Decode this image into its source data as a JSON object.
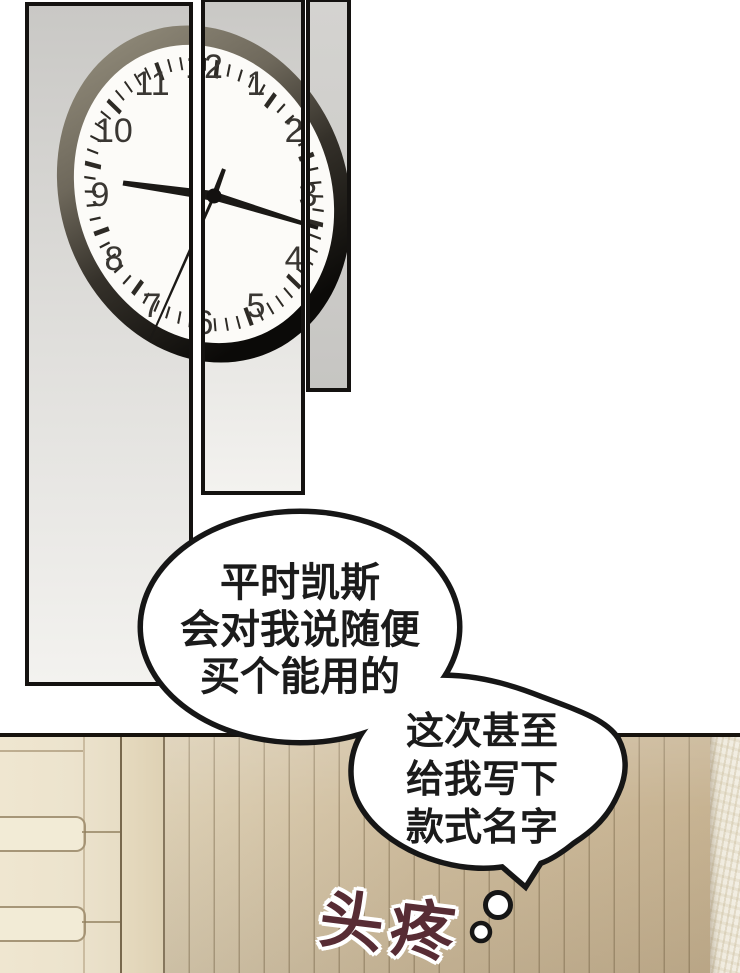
{
  "page": {
    "width": 740,
    "height": 973,
    "kind": "comic page"
  },
  "clock": {
    "numerals": [
      "1",
      "2",
      "3",
      "4",
      "5",
      "6",
      "7",
      "8",
      "9",
      "10",
      "11",
      "12"
    ],
    "depicted_time": "9:19"
  },
  "bubble1": {
    "lines": [
      "平时凯斯",
      "会对我说随便",
      "买个能用的"
    ]
  },
  "bubble2": {
    "lines": [
      "这次甚至",
      "给我写下",
      "款式名字"
    ]
  },
  "thought_sfx": {
    "text": "头疼"
  },
  "colors": {
    "outline": "#161616",
    "wall": "#cdbb9d",
    "wall_light_column": "#f1ede2",
    "cabinet": "#ece3cd",
    "sfx_text": "#572c34",
    "clock_face": "#fcfbf8",
    "clock_rim_top": "#938d7c",
    "clock_rim_bottom": "#0b0a08",
    "panel_bg_top": "#c9c8c5",
    "panel_bg_bottom": "#f3f2ef"
  }
}
